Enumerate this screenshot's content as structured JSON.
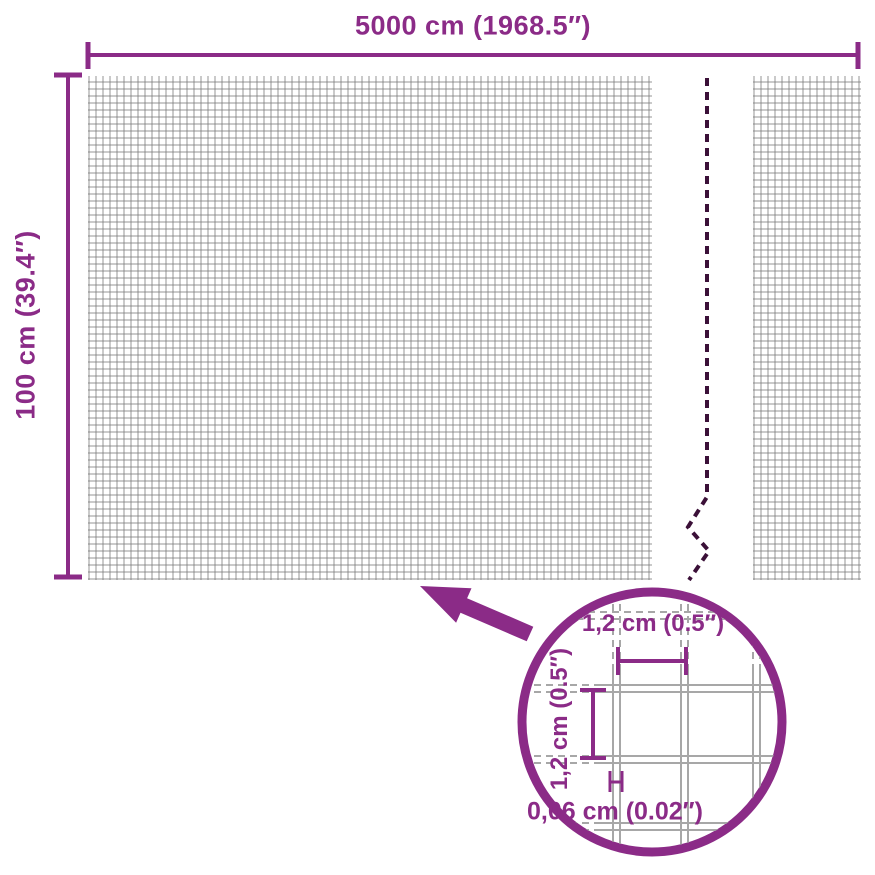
{
  "diagram": {
    "title": "Mesh fence product dimensions diagram",
    "width_label": "5000 cm (1968.5″)",
    "height_label": "100 cm (39.4″)",
    "detail": {
      "mesh_width_label": "1,2 cm (0.5″)",
      "mesh_height_label": "1,2 cm (0.5″)",
      "wire_thickness_label": "0,06 cm (0.02″)"
    },
    "colors": {
      "accent_purple": "#8b2b87",
      "break_line_dark": "#3b1038",
      "mesh_line_gray": "#bdbdbd",
      "magnified_wire_gray": "#a7a7a7",
      "background": "#ffffff"
    }
  }
}
